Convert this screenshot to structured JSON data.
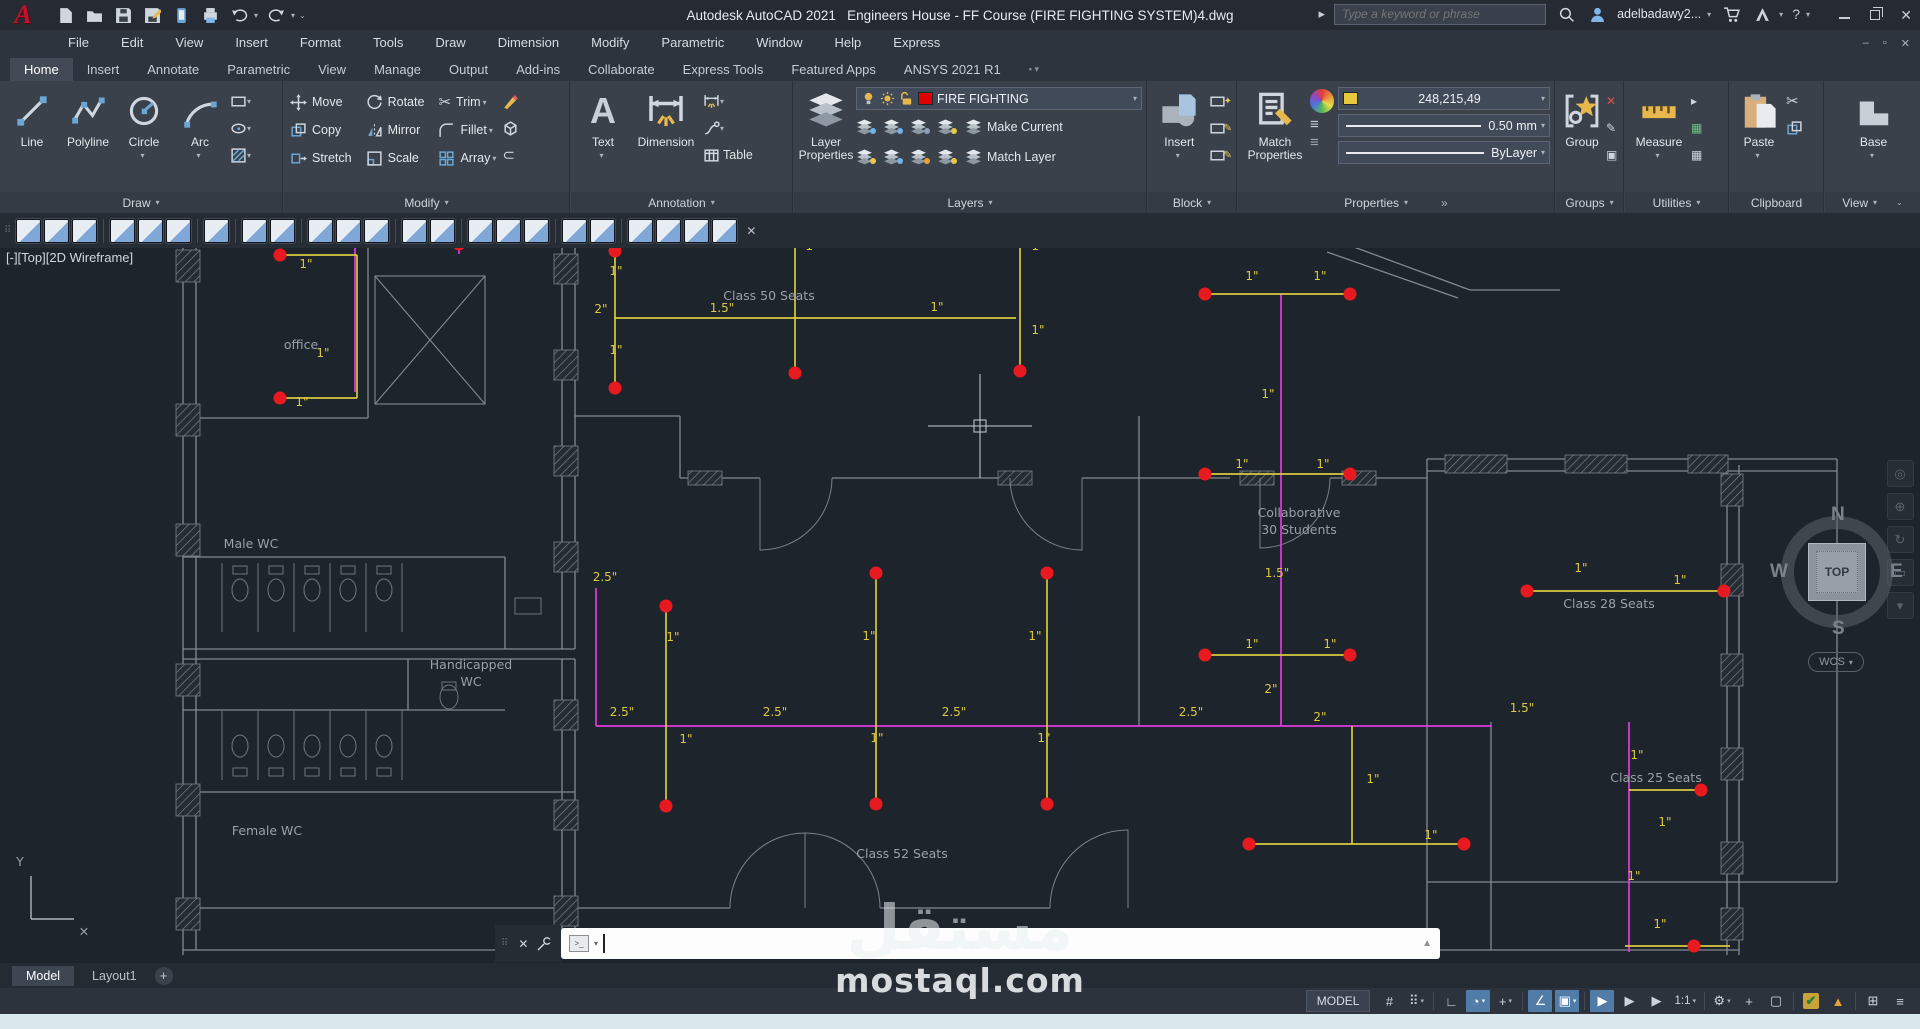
{
  "titlebar": {
    "app_title": "Autodesk AutoCAD 2021",
    "doc_title": "Engineers House - FF Course (FIRE FIGHTING SYSTEM)4.dwg",
    "search_placeholder": "Type a keyword or phrase",
    "username": "adelbadawy2..."
  },
  "menubar": {
    "items": [
      "File",
      "Edit",
      "View",
      "Insert",
      "Format",
      "Tools",
      "Draw",
      "Dimension",
      "Modify",
      "Parametric",
      "Window",
      "Help",
      "Express"
    ]
  },
  "ribbon_tabs": [
    {
      "label": "Home",
      "active": true
    },
    {
      "label": "Insert"
    },
    {
      "label": "Annotate"
    },
    {
      "label": "Parametric"
    },
    {
      "label": "View"
    },
    {
      "label": "Manage"
    },
    {
      "label": "Output"
    },
    {
      "label": "Add-ins"
    },
    {
      "label": "Collaborate"
    },
    {
      "label": "Express Tools"
    },
    {
      "label": "Featured Apps"
    },
    {
      "label": "ANSYS  2021 R1"
    }
  ],
  "ribbon": {
    "draw": {
      "footer": "Draw",
      "big": [
        {
          "l": "Line",
          "i": "line"
        },
        {
          "l": "Polyline",
          "i": "polyline"
        },
        {
          "l": "Circle",
          "i": "circle",
          "c": 1
        },
        {
          "l": "Arc",
          "i": "arc",
          "c": 1
        }
      ],
      "minis": [
        "rect",
        "ellipse",
        "hatch"
      ]
    },
    "modify": {
      "footer": "Modify",
      "items": [
        {
          "l": "Move",
          "i": "move"
        },
        {
          "l": "Copy",
          "i": "copy"
        },
        {
          "l": "Stretch",
          "i": "stretch"
        },
        {
          "l": "Rotate",
          "i": "rotate"
        },
        {
          "l": "Mirror",
          "i": "mirror"
        },
        {
          "l": "Scale",
          "i": "scale"
        },
        {
          "l": "Trim",
          "i": "trim",
          "c": 1
        },
        {
          "l": "Fillet",
          "i": "fillet",
          "c": 1
        },
        {
          "l": "Array",
          "i": "array",
          "c": 1
        }
      ]
    },
    "annotation": {
      "footer": "Annotation",
      "text_label": "Text",
      "dimension_label": "Dimension",
      "table_label": "Table"
    },
    "layers": {
      "footer": "Layers",
      "layer_properties_1": "Layer",
      "layer_properties_2": "Properties",
      "current_layer": "FIRE FIGHTING",
      "make_current": "Make Current",
      "match_layer": "Match Layer",
      "mini_dots": [
        "#6fb3e8",
        "#6fb3e8",
        "#8ea0b4",
        "#e8c84c",
        "#e8c84c",
        "#6fb3e8",
        "#e8a23c",
        "#e8c84c"
      ]
    },
    "block": {
      "footer": "Block",
      "insert_label": "Insert",
      "mini_glyphs": [
        "✦",
        "✎",
        "✎"
      ]
    },
    "properties": {
      "footer": "Properties",
      "match_1": "Match",
      "match_2": "Properties",
      "color_value": "248,215,49",
      "lineweight": "0.50 mm",
      "linetype": "ByLayer",
      "overflow": "»"
    },
    "groups": {
      "footer": "Groups",
      "group_label": "Group",
      "mini_glyphs": [
        "✕",
        "✎",
        "▣"
      ]
    },
    "utilities": {
      "footer": "Utilities",
      "measure_label": "Measure",
      "mini_glyphs": [
        "▸",
        "▦",
        "▦"
      ]
    },
    "clipboard": {
      "footer": "Clipboard",
      "paste_label": "Paste"
    },
    "view": {
      "footer": "View",
      "base_label": "Base"
    }
  },
  "toolbar2": {
    "groups": [
      3,
      3,
      1,
      2,
      3,
      2,
      3,
      2,
      4
    ],
    "close": "✕"
  },
  "viewport": {
    "label": "[-][Top][2D Wireframe]",
    "viewcube": {
      "n": "N",
      "w": "W",
      "e": "E",
      "s": "S",
      "top": "TOP",
      "wcs": "WCS"
    },
    "navbar_glyphs": [
      "◎",
      "⊕",
      "↻",
      "▭",
      "▾"
    ]
  },
  "drawing": {
    "walls": [
      [
        183,
        240,
        183,
        955
      ],
      [
        196,
        240,
        196,
        950
      ],
      [
        183,
        240,
        1335,
        240
      ],
      [
        1335,
        240,
        1470,
        290
      ],
      [
        1327,
        252,
        1458,
        298
      ],
      [
        1470,
        290,
        1560,
        290
      ],
      [
        562,
        240,
        562,
        649
      ],
      [
        575,
        240,
        575,
        649
      ],
      [
        562,
        659,
        562,
        950
      ],
      [
        575,
        659,
        575,
        950
      ],
      [
        368,
        240,
        368,
        418
      ],
      [
        183,
        418,
        368,
        418
      ],
      [
        183,
        557,
        505,
        557
      ],
      [
        505,
        557,
        505,
        649
      ],
      [
        183,
        649,
        575,
        649
      ],
      [
        183,
        659,
        575,
        659
      ],
      [
        408,
        659,
        408,
        710
      ],
      [
        183,
        710,
        505,
        710
      ],
      [
        183,
        792,
        575,
        792
      ],
      [
        183,
        908,
        575,
        908
      ],
      [
        575,
        416,
        680,
        416
      ],
      [
        680,
        416,
        680,
        478
      ],
      [
        680,
        478,
        760,
        478
      ],
      [
        832,
        478,
        1010,
        478
      ],
      [
        1082,
        478,
        1139,
        478
      ],
      [
        1139,
        416,
        1139,
        726
      ],
      [
        1139,
        478,
        1230,
        478
      ],
      [
        1330,
        478,
        1427,
        478
      ],
      [
        1427,
        459,
        1837,
        459
      ],
      [
        1427,
        471,
        1837,
        471
      ],
      [
        1427,
        459,
        1427,
        955
      ],
      [
        1727,
        465,
        1727,
        955
      ],
      [
        1739,
        465,
        1739,
        955
      ],
      [
        1837,
        459,
        1837,
        882
      ],
      [
        1427,
        882,
        1837,
        882
      ],
      [
        1491,
        722,
        1491,
        950
      ],
      [
        575,
        908,
        730,
        908
      ],
      [
        880,
        908,
        1050,
        908
      ],
      [
        183,
        950,
        1739,
        950
      ]
    ],
    "piers": [
      [
        176,
        250,
        24,
        32
      ],
      [
        176,
        404,
        24,
        32
      ],
      [
        176,
        524,
        24,
        32
      ],
      [
        176,
        664,
        24,
        32
      ],
      [
        176,
        784,
        24,
        32
      ],
      [
        176,
        898,
        24,
        32
      ],
      [
        554,
        254,
        24,
        30
      ],
      [
        554,
        350,
        24,
        30
      ],
      [
        554,
        446,
        24,
        30
      ],
      [
        554,
        542,
        24,
        30
      ],
      [
        554,
        700,
        24,
        30
      ],
      [
        554,
        800,
        24,
        30
      ],
      [
        554,
        896,
        24,
        30
      ],
      [
        610,
        234,
        46,
        12
      ],
      [
        762,
        234,
        46,
        12
      ],
      [
        988,
        234,
        46,
        12
      ],
      [
        1122,
        234,
        46,
        12
      ],
      [
        688,
        471,
        34,
        14
      ],
      [
        998,
        471,
        34,
        14
      ],
      [
        1240,
        471,
        34,
        14
      ],
      [
        1342,
        471,
        34,
        14
      ],
      [
        1445,
        455,
        62,
        18
      ],
      [
        1565,
        455,
        62,
        18
      ],
      [
        1688,
        455,
        40,
        18
      ],
      [
        1721,
        474,
        22,
        32
      ],
      [
        1721,
        564,
        22,
        32
      ],
      [
        1721,
        654,
        22,
        32
      ],
      [
        1721,
        748,
        22,
        32
      ],
      [
        1721,
        842,
        22,
        32
      ],
      [
        1721,
        908,
        22,
        32
      ]
    ],
    "doors": [
      "M832,478 A72,72 0 0 1 760,550 L760,478",
      "M1010,478 A72,72 0 0 0 1082,550 L1082,478",
      "M730,908 A75,75 0 0 1 805,833 L805,908",
      "M880,908 A75,75 0 0 0 805,833",
      "M1050,908 A78,78 0 0 1 1128,830 L1128,908",
      "M1330,478 A70,70 0 0 1 1260,548 L1260,478"
    ],
    "xbox": [
      375,
      276,
      110,
      128
    ],
    "stall_xs": [
      222,
      258,
      294,
      330,
      366,
      402
    ],
    "male_stall_y": [
      563,
      632
    ],
    "female_stall_y": [
      710,
      780
    ],
    "extra_rects": [
      [
        515,
        598,
        26,
        16
      ],
      [
        442,
        682,
        14,
        8
      ]
    ],
    "mpipes": [
      [
        355,
        240,
        355,
        392
      ],
      [
        459,
        240,
        459,
        254
      ],
      [
        1281,
        294,
        1281,
        726
      ],
      [
        596,
        588,
        596,
        726
      ],
      [
        596,
        726,
        1491,
        726
      ],
      [
        1629,
        722,
        1629,
        952
      ]
    ],
    "ypipes": [
      [
        280,
        255,
        357,
        255
      ],
      [
        357,
        255,
        357,
        398
      ],
      [
        280,
        398,
        357,
        398
      ],
      [
        615,
        251,
        615,
        388
      ],
      [
        615,
        318,
        1016,
        318
      ],
      [
        795,
        240,
        795,
        373
      ],
      [
        1020,
        240,
        1020,
        371
      ],
      [
        1205,
        294,
        1350,
        294
      ],
      [
        1205,
        474,
        1350,
        474
      ],
      [
        1205,
        655,
        1350,
        655
      ],
      [
        666,
        606,
        666,
        806
      ],
      [
        876,
        573,
        876,
        804
      ],
      [
        1047,
        573,
        1047,
        804
      ],
      [
        1527,
        591,
        1724,
        591
      ],
      [
        1249,
        844,
        1464,
        844
      ],
      [
        1352,
        726,
        1352,
        844
      ],
      [
        1629,
        790,
        1701,
        790
      ],
      [
        1625,
        946,
        1730,
        946
      ]
    ],
    "sprinklers": [
      [
        280,
        255
      ],
      [
        459,
        244
      ],
      [
        615,
        251
      ],
      [
        615,
        388
      ],
      [
        795,
        373
      ],
      [
        1020,
        371
      ],
      [
        1205,
        294
      ],
      [
        1350,
        294
      ],
      [
        1205,
        474
      ],
      [
        1350,
        474
      ],
      [
        280,
        398
      ],
      [
        666,
        606
      ],
      [
        666,
        806
      ],
      [
        876,
        573
      ],
      [
        876,
        804
      ],
      [
        1047,
        573
      ],
      [
        1047,
        804
      ],
      [
        1205,
        655
      ],
      [
        1350,
        655
      ],
      [
        1527,
        591
      ],
      [
        1724,
        591
      ],
      [
        1249,
        844
      ],
      [
        1464,
        844
      ],
      [
        1701,
        790
      ],
      [
        1694,
        946
      ]
    ],
    "dim_labels": [
      [
        306,
        268,
        "1\""
      ],
      [
        323,
        357,
        "1\""
      ],
      [
        302,
        406,
        "1\""
      ],
      [
        616,
        275,
        "1\""
      ],
      [
        601,
        313,
        "2\""
      ],
      [
        616,
        354,
        "1\""
      ],
      [
        576,
        247,
        "2"
      ],
      [
        722,
        312,
        "1.5\""
      ],
      [
        937,
        311,
        "1\""
      ],
      [
        812,
        250,
        "1\""
      ],
      [
        1038,
        250,
        "1\""
      ],
      [
        1038,
        334,
        "1\""
      ],
      [
        1252,
        280,
        "1\""
      ],
      [
        1320,
        280,
        "1\""
      ],
      [
        1268,
        398,
        "1\""
      ],
      [
        1242,
        468,
        "1\""
      ],
      [
        1323,
        468,
        "1\""
      ],
      [
        1277,
        577,
        "1.5\""
      ],
      [
        1252,
        648,
        "1\""
      ],
      [
        1330,
        648,
        "1\""
      ],
      [
        1271,
        693,
        "2\""
      ],
      [
        1320,
        721,
        "2\""
      ],
      [
        605,
        581,
        "2.5\""
      ],
      [
        622,
        716,
        "2.5\""
      ],
      [
        775,
        716,
        "2.5\""
      ],
      [
        954,
        716,
        "2.5\""
      ],
      [
        1191,
        716,
        "2.5\""
      ],
      [
        673,
        641,
        "1\""
      ],
      [
        686,
        743,
        "1\""
      ],
      [
        869,
        640,
        "1\""
      ],
      [
        877,
        742,
        "1\""
      ],
      [
        1035,
        640,
        "1\""
      ],
      [
        1044,
        742,
        "1\""
      ],
      [
        1581,
        572,
        "1\""
      ],
      [
        1680,
        584,
        "1\""
      ],
      [
        1637,
        759,
        "1\""
      ],
      [
        1634,
        880,
        "1\""
      ],
      [
        1665,
        826,
        "1\""
      ],
      [
        1373,
        783,
        "1\""
      ],
      [
        1431,
        839,
        "1\""
      ],
      [
        1660,
        928,
        "1\""
      ],
      [
        1522,
        712,
        "1.5\""
      ]
    ],
    "room_labels": [
      [
        301,
        349,
        "office"
      ],
      [
        251,
        548,
        "Male WC"
      ],
      [
        471,
        669,
        "Handicapped"
      ],
      [
        471,
        686,
        "WC"
      ],
      [
        267,
        835,
        "Female WC"
      ],
      [
        769,
        300,
        "Class 50 Seats"
      ],
      [
        902,
        858,
        "Class 52 Seats"
      ],
      [
        1299,
        517,
        "Collaborative"
      ],
      [
        1299,
        534,
        "30 Students"
      ],
      [
        1609,
        608,
        "Class 28 Seats"
      ],
      [
        1656,
        782,
        "Class 25 Seats"
      ]
    ],
    "crosshair": [
      980,
      426
    ],
    "ucs": {
      "y_label": "Y",
      "x_mark": "✕"
    }
  },
  "command_bar": {
    "chip": ">_",
    "up_arrow": "▲"
  },
  "model_tabs": {
    "model": "Model",
    "layout": "Layout1",
    "add": "+"
  },
  "status_bar": {
    "model_label": "MODEL",
    "scale": "1:1",
    "items": [
      {
        "g": "#"
      },
      {
        "g": "⠿",
        "c": 1
      },
      {
        "s": 1
      },
      {
        "g": "∟"
      },
      {
        "g": "◔",
        "a": 1,
        "c": 1
      },
      {
        "g": "+",
        "c": 1
      },
      {
        "s": 1
      },
      {
        "g": "∠",
        "a": 1
      },
      {
        "g": "▣",
        "a": 1,
        "c": 1
      },
      {
        "s": 1
      },
      {
        "g": "▶",
        "a": 1
      },
      {
        "g": "▶"
      },
      {
        "g": "▶"
      },
      {
        "t": "1:1",
        "c": 1
      },
      {
        "s": 1
      },
      {
        "g": "⚙",
        "c": 1
      },
      {
        "g": "+"
      },
      {
        "g": "▢"
      },
      {
        "s": 1
      },
      {
        "g": "✔",
        "perf": 1
      },
      {
        "g": "▲",
        "tri": 1
      },
      {
        "s": 1
      },
      {
        "g": "⊞"
      },
      {
        "g": "≡"
      }
    ]
  },
  "watermark": {
    "arabic": "مستقل",
    "latin": "mostaql.com"
  },
  "colors": {
    "accent_blue": "#6ba7d4",
    "layer_red": "#e00000",
    "color_swatch_yellow": "#e8c83c",
    "pipe_yellow": "#d9c93d",
    "pipe_magenta": "#e23ae2",
    "sprinkler_red": "#e8191f"
  }
}
